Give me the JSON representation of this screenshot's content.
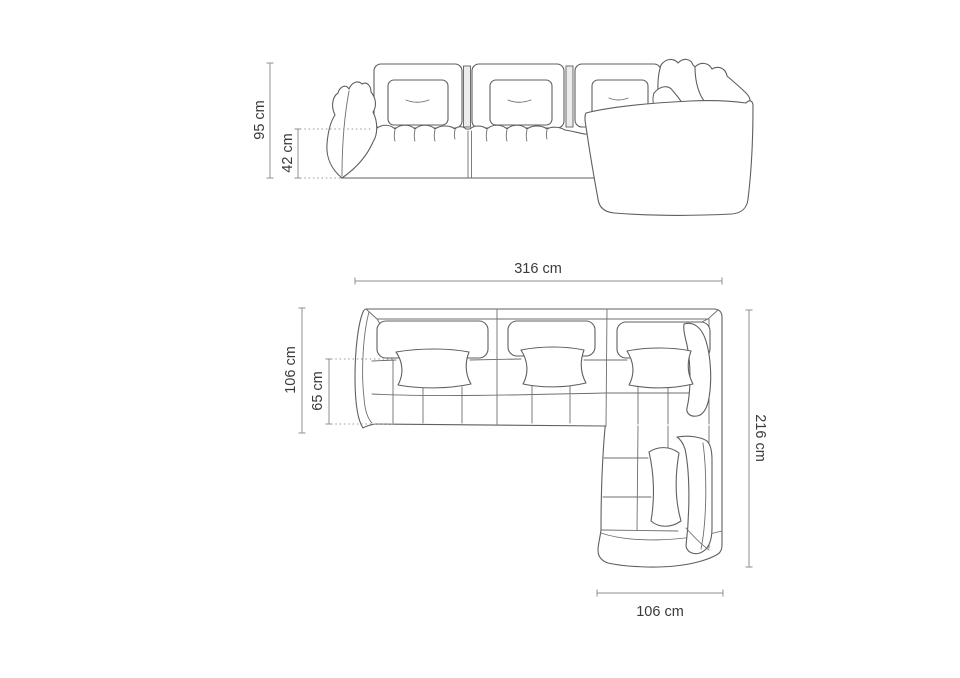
{
  "document": {
    "title": "Modular corner sofa dimension drawing",
    "background": "#ffffff"
  },
  "colors": {
    "outline": "#5f5f5f",
    "dimension_line": "#8f8f8f",
    "label_text": "#3a3a3a",
    "background": "#ffffff"
  },
  "views": {
    "front_elevation": {
      "name": "front-elevation",
      "dims": {
        "total_height": "95 cm",
        "seat_height": "42 cm"
      }
    },
    "top_plan": {
      "name": "top-plan",
      "dims": {
        "total_width": "316 cm",
        "body_depth": "106 cm",
        "seat_depth": "65 cm",
        "total_depth": "216 cm",
        "chaise_width": "106 cm"
      }
    }
  }
}
